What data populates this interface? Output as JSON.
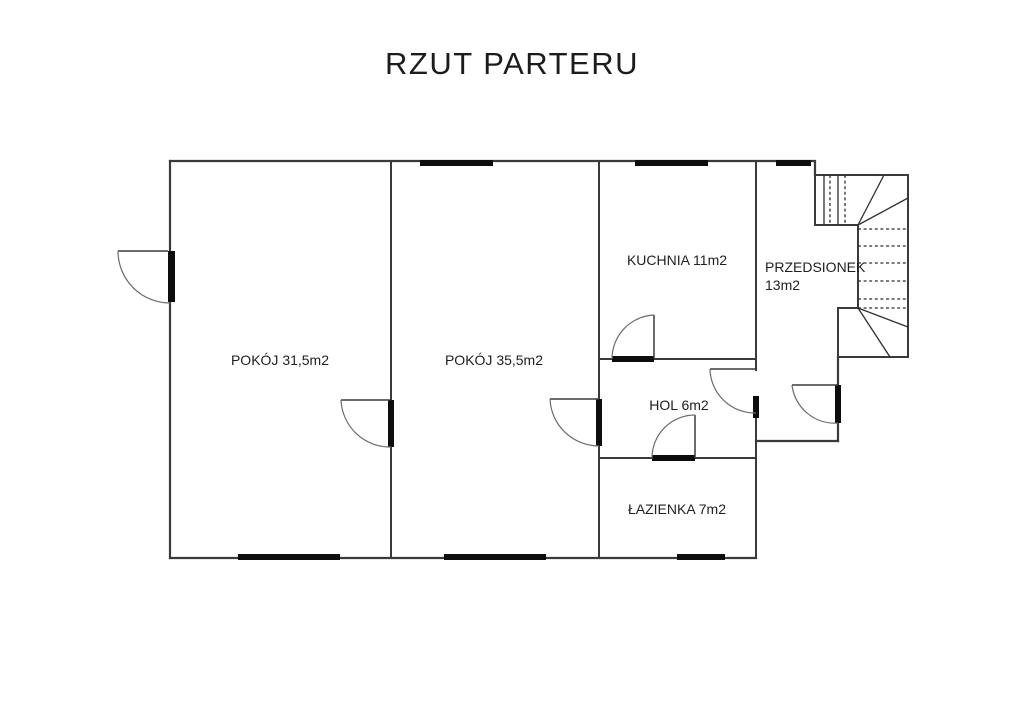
{
  "title": "RZUT PARTERU",
  "plan": {
    "rooms": [
      {
        "name": "pokoj-1",
        "label": "POKÓJ 31,5m2"
      },
      {
        "name": "pokoj-2",
        "label": "POKÓJ 35,5m2"
      },
      {
        "name": "kuchnia",
        "label": "KUCHNIA 11m2"
      },
      {
        "name": "przedsionek",
        "label": "PRZEDSIONEK",
        "area_label": "13m2"
      },
      {
        "name": "hol",
        "label": "HOL 6m2"
      },
      {
        "name": "lazienka",
        "label": "ŁAZIENKA 7m2"
      }
    ],
    "colors": {
      "background": "#ffffff",
      "wall_line": "#3a3a3a",
      "window_door_bar": "#0d0d0d",
      "swing_arc": "#6b6b6b",
      "text": "#1f1f1f"
    }
  }
}
